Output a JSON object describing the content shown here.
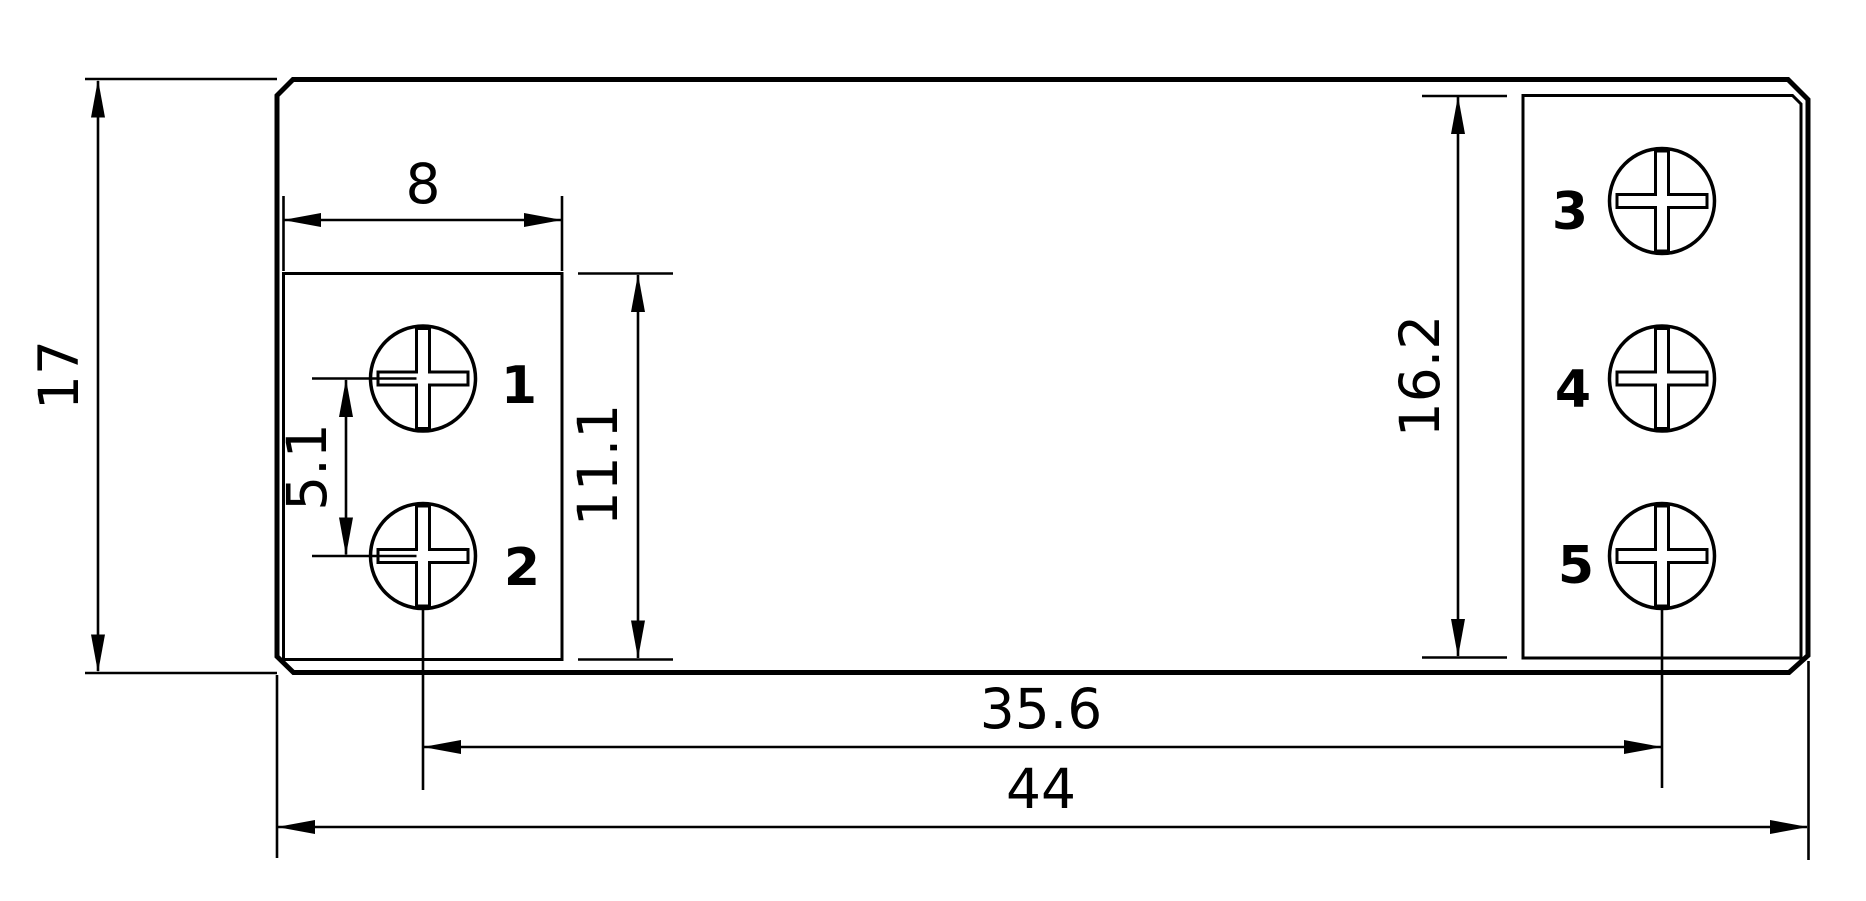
{
  "drawing": {
    "background": "#ffffff",
    "line_color": "#000000",
    "label_color": "#e81a1c",
    "dimensions": {
      "overall_height": "17",
      "block_width": "8",
      "screw_spacing": "5.1",
      "left_block_height": "11.1",
      "right_block_height": "16.2",
      "screw_span": "35.6",
      "overall_width": "44"
    },
    "terminals": [
      {
        "label": "1"
      },
      {
        "label": "2"
      },
      {
        "label": "3"
      },
      {
        "label": "4"
      },
      {
        "label": "5"
      }
    ]
  }
}
